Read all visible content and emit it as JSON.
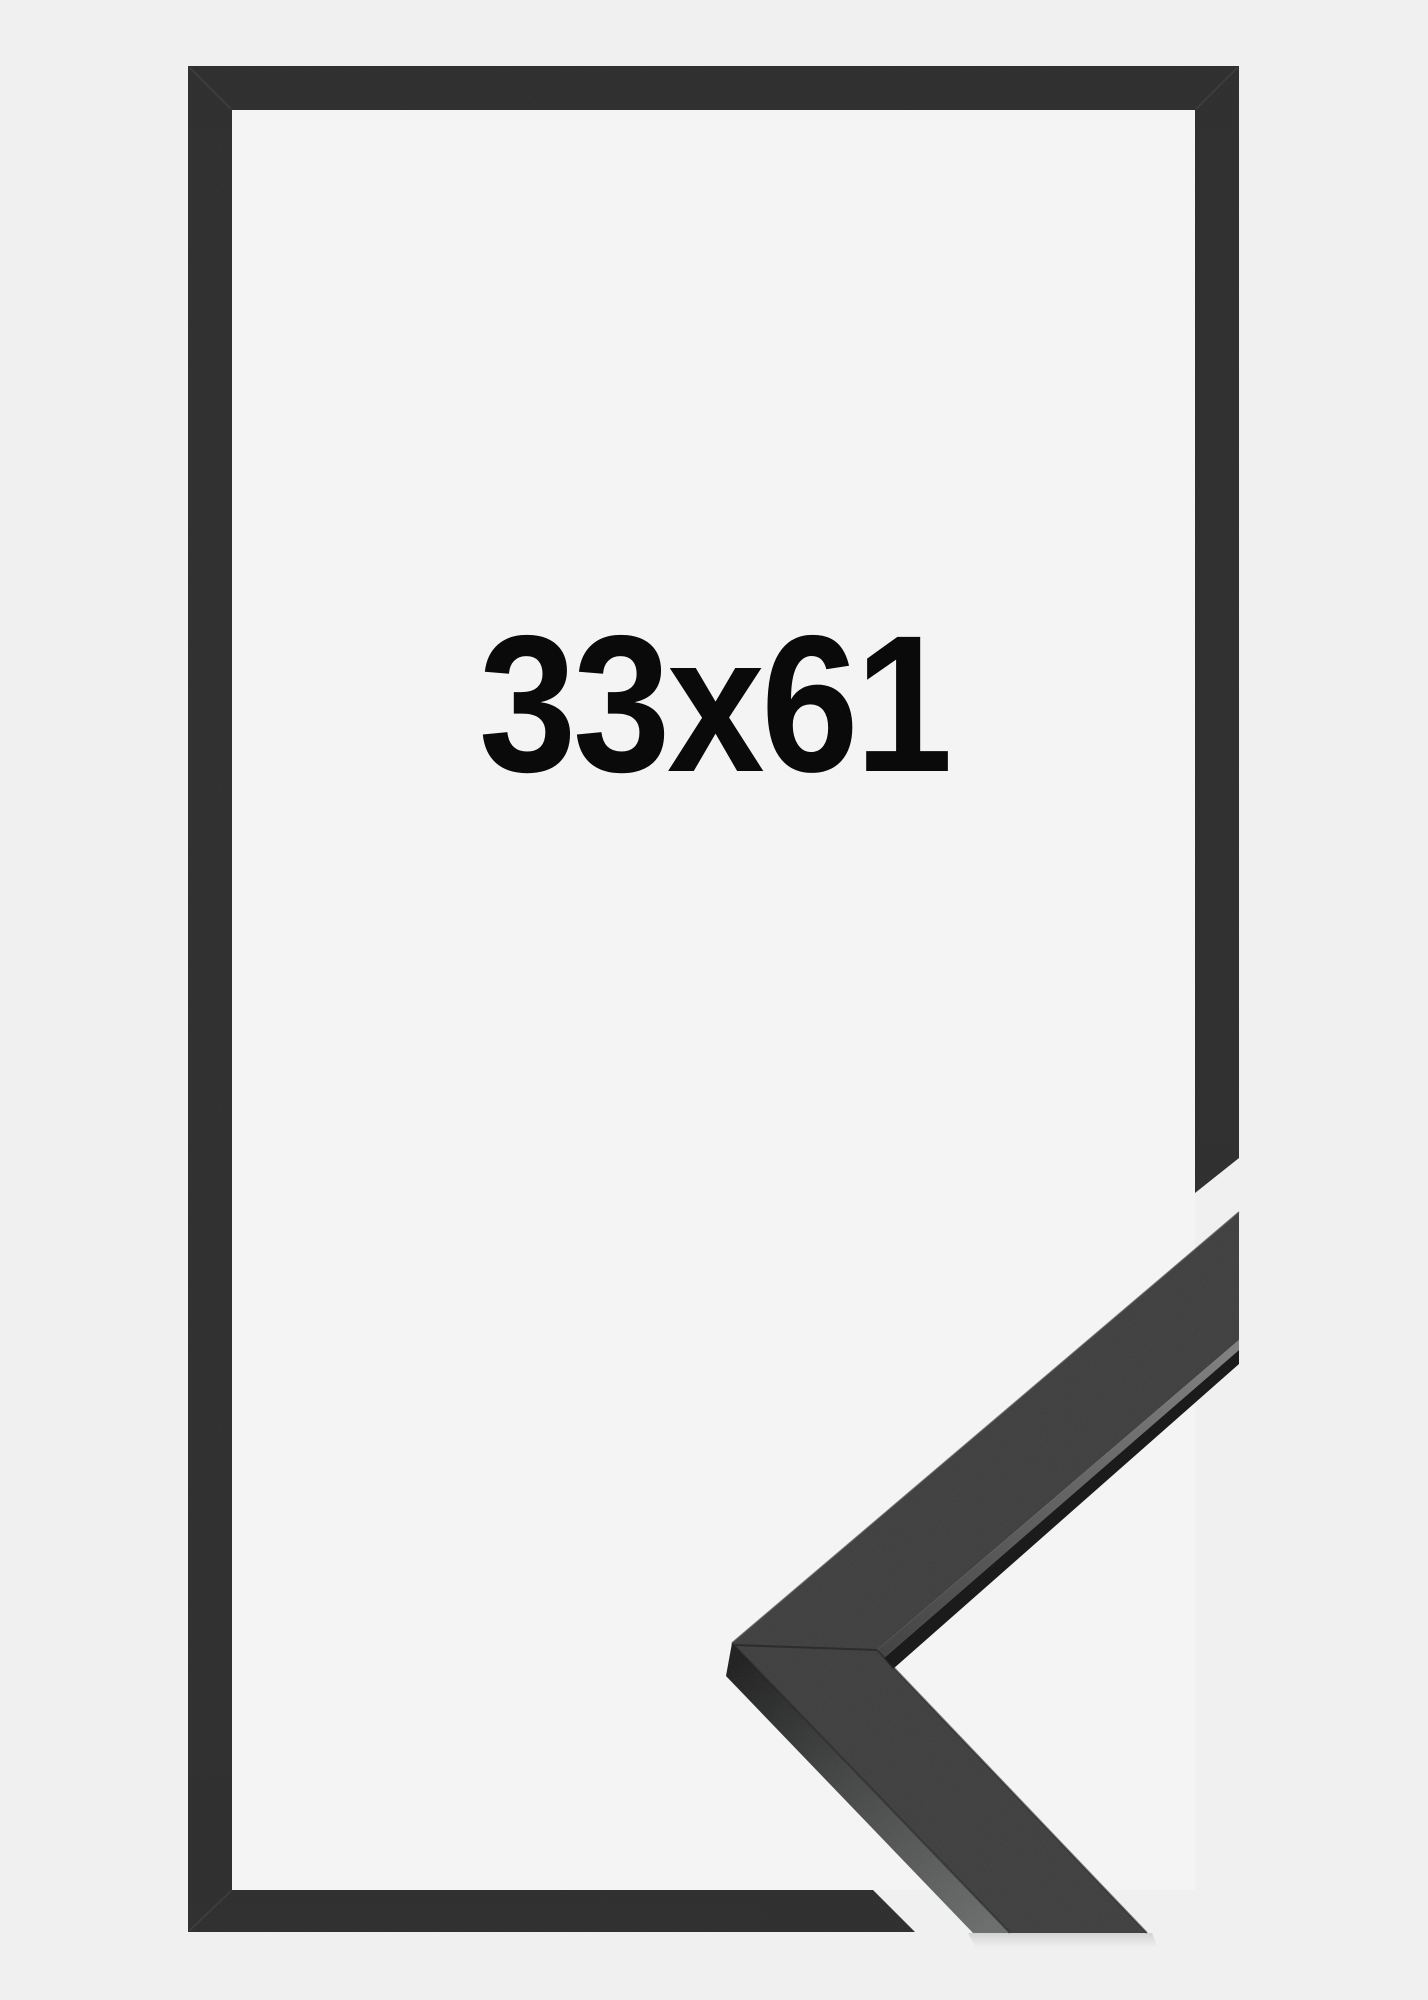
{
  "size_label": "33x61",
  "colors": {
    "background": "#f0f0f1",
    "inside_frame": "#f4f4f5",
    "frame": "#2e2e2e",
    "label_text": "#0a0a0a",
    "moulding_top_face": "#3d3d3d",
    "moulding_side_light": "#696b6b",
    "moulding_underside": "#1b1b1b",
    "inner_lip_highlight": "#7d7d7d",
    "miter_seam": "#3f3f3f"
  }
}
